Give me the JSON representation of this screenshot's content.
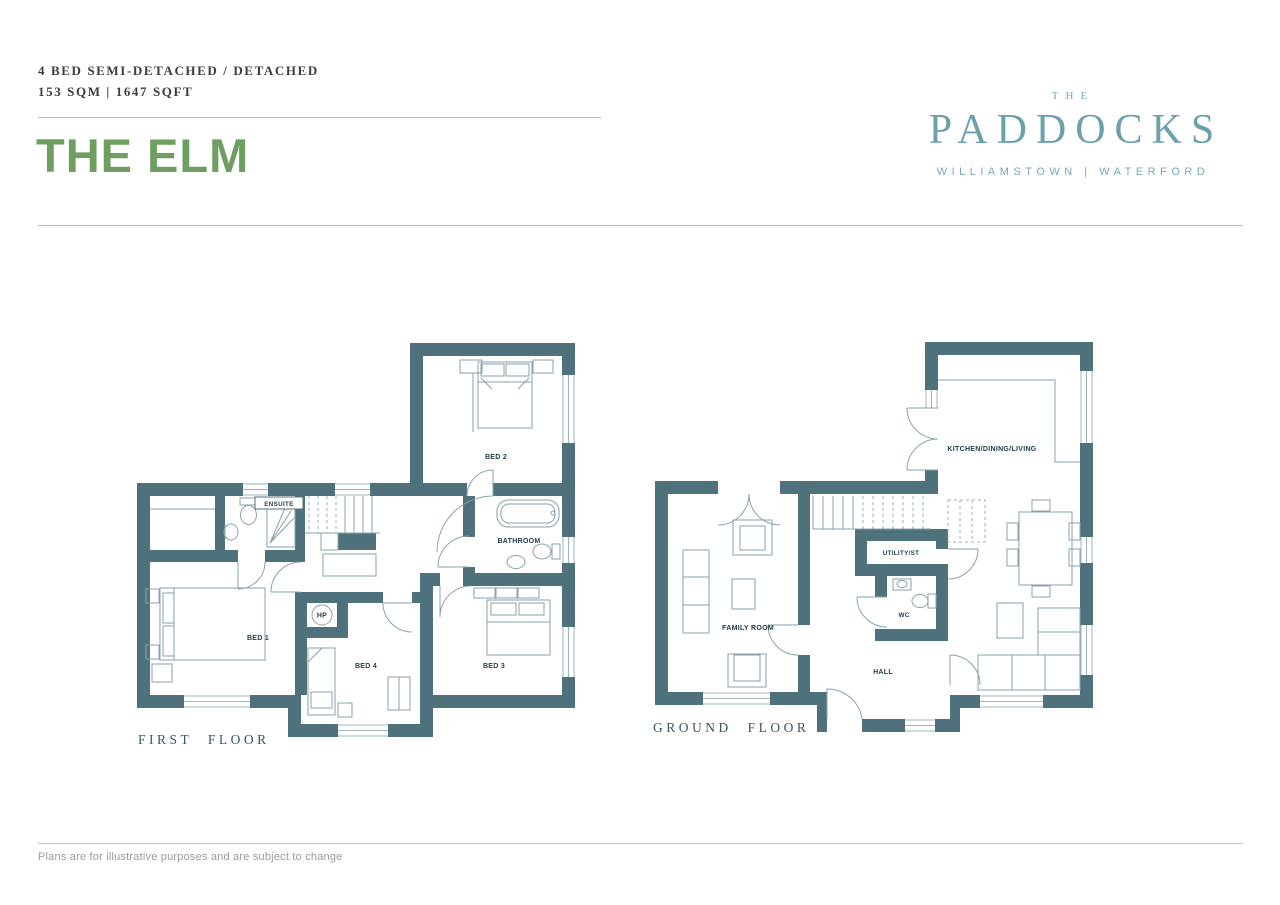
{
  "header": {
    "type_label": "4 BED SEMI-DETACHED / DETACHED",
    "area_label": "153 SQM | 1647 SQFT",
    "title": "THE ELM"
  },
  "brand": {
    "the": "THE",
    "name": "PADDOCKS",
    "location": "WILLIAMSTOWN | WATERFORD"
  },
  "plans": {
    "first_floor": {
      "label": "FIRST FLOOR",
      "rooms": {
        "bed1": "BED 1",
        "bed2": "BED 2",
        "bed3": "BED 3",
        "bed4": "BED 4",
        "ensuite": "ENSUITE",
        "bathroom": "BATHROOM",
        "hp": "HP"
      }
    },
    "ground_floor": {
      "label": "GROUND FLOOR",
      "rooms": {
        "kitchen": "KITCHEN/DINING/LIVING",
        "family": "FAMILY ROOM",
        "utility": "UTILITY/ST",
        "wc": "WC",
        "hall": "HALL"
      }
    }
  },
  "footer": {
    "disclaimer": "Plans are for illustrative purposes and are subject to change"
  },
  "colors": {
    "wall_teal": "#4e717c",
    "accent_green": "#6f9e61",
    "brand_teal": "#6ba1aa",
    "label_navy": "#1d3c49"
  }
}
